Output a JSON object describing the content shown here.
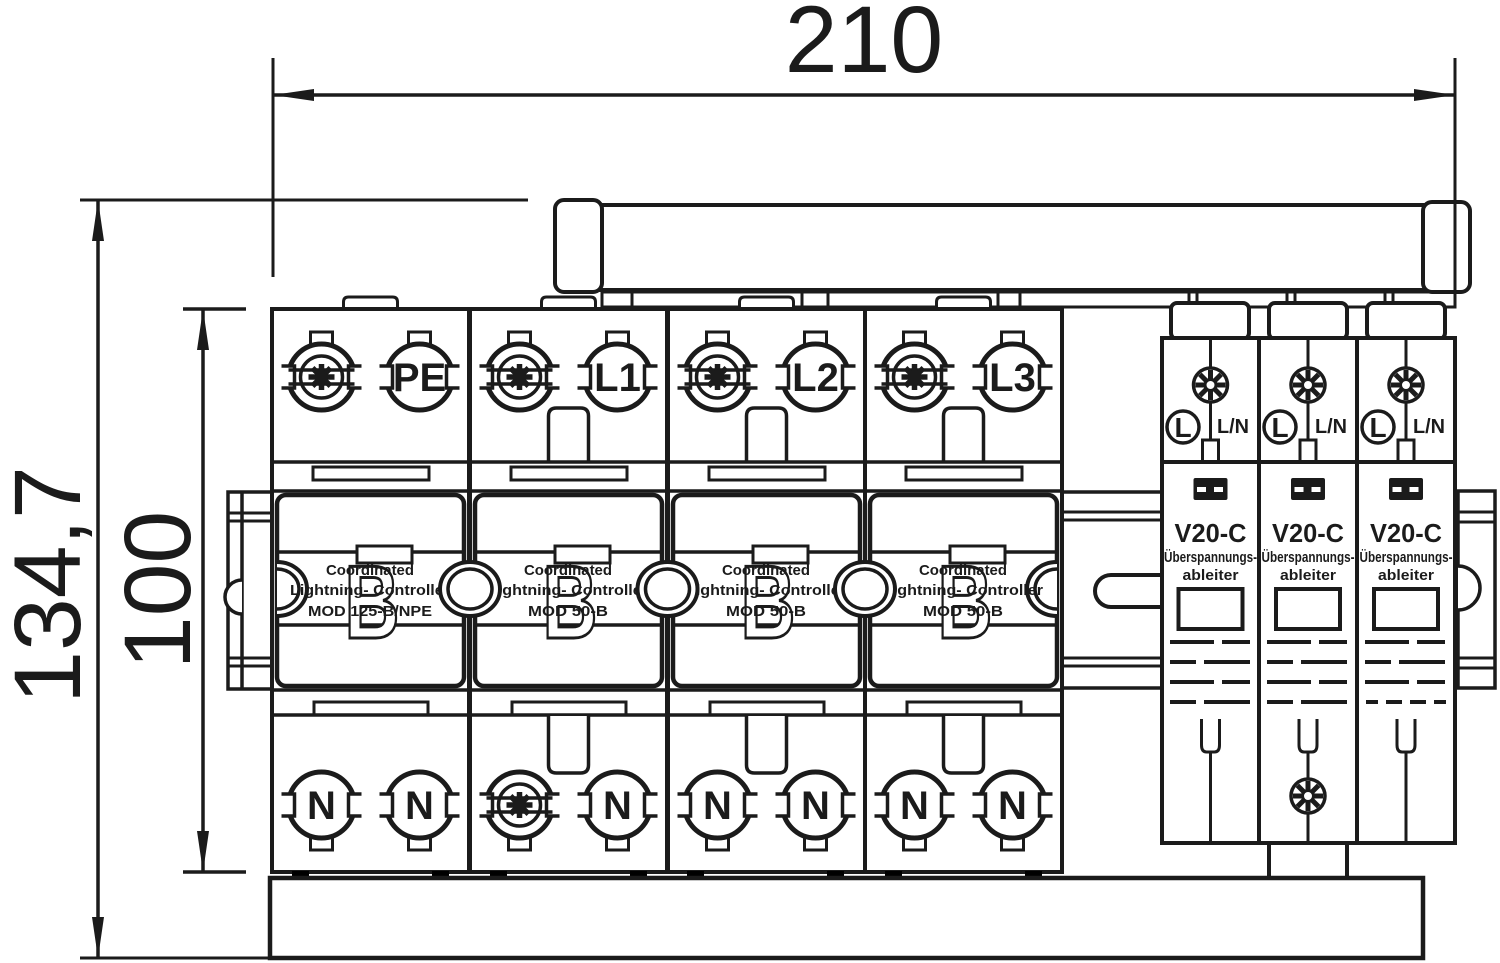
{
  "drawing": {
    "background": "#ffffff",
    "line_color": "#1b1b1b",
    "dimensions": {
      "width_mm": "210",
      "total_height_mm": "134,7",
      "module_height_mm": "100"
    },
    "main_modules": [
      {
        "phase_label": "PE",
        "desc_line1": "Coordinated",
        "desc_line2": "Lightning- Controller",
        "desc_line3": "MOD 125-B/NPE",
        "watermark": "B",
        "bottom_left_terminal": "N",
        "bottom_left_label": "N",
        "bottom_right_label": "N"
      },
      {
        "phase_label": "L1",
        "desc_line1": "Coordinated",
        "desc_line2": "Lightning- Controller",
        "desc_line3": "MOD 50-B",
        "watermark": "B",
        "bottom_left_terminal": "screw",
        "bottom_right_label": "N"
      },
      {
        "phase_label": "L2",
        "desc_line1": "Coordinated",
        "desc_line2": "Lightning- Controller",
        "desc_line3": "MOD 50-B",
        "watermark": "B",
        "bottom_left_terminal": "N",
        "bottom_left_label": "N",
        "bottom_right_label": "N"
      },
      {
        "phase_label": "L3",
        "desc_line1": "Coordinated",
        "desc_line2": "Lightning- Controller",
        "desc_line3": "MOD 50-B",
        "watermark": "B",
        "bottom_left_terminal": "N",
        "bottom_left_label": "N",
        "bottom_right_label": "N"
      }
    ],
    "spd_modules": [
      {
        "terminal_left_label": "L",
        "terminal_right_label": "L/N",
        "type_label": "V20-C",
        "desc_line1": "Überspannungs-",
        "desc_line2": "ableiter"
      },
      {
        "terminal_left_label": "L",
        "terminal_right_label": "L/N",
        "type_label": "V20-C",
        "desc_line1": "Überspannungs-",
        "desc_line2": "ableiter"
      },
      {
        "terminal_left_label": "L",
        "terminal_right_label": "L/N",
        "type_label": "V20-C",
        "desc_line1": "Überspannungs-",
        "desc_line2": "ableiter"
      }
    ]
  }
}
